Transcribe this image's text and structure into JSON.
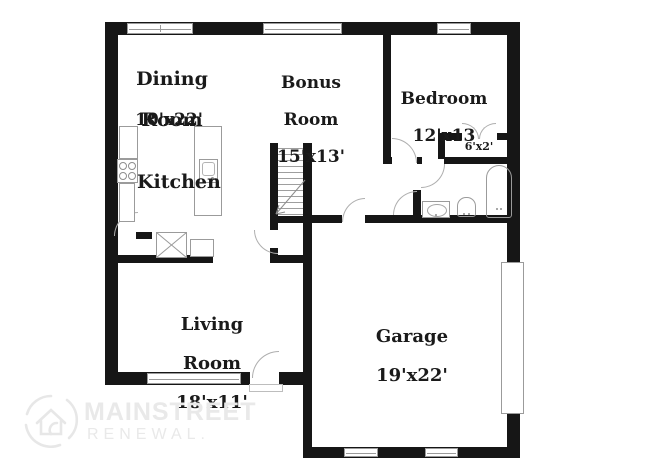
{
  "plan": {
    "rooms": {
      "dining": {
        "line1": "Dining",
        "line2": "Room",
        "dims": "10'x22'"
      },
      "bonus": {
        "line1": "Bonus",
        "line2": "Room",
        "dims": "15'x13'"
      },
      "bedroom": {
        "line1": "Bedroom",
        "dims": "12'x13"
      },
      "kitchen": {
        "line1": "Kitchen"
      },
      "living": {
        "line1": "Living",
        "line2": "Room",
        "dims": "18'x11'"
      },
      "garage": {
        "line1": "Garage",
        "dims": "19'x22'"
      },
      "closet": {
        "dims": "6'x2'"
      }
    }
  },
  "watermark": {
    "brand": "MAINSTREET",
    "sub": "RENEWAL."
  },
  "colors": {
    "wall": "#161616",
    "fixture_line": "#9b9b9b",
    "label_text": "#1a1a1a",
    "watermark": "#e9e9e9"
  }
}
